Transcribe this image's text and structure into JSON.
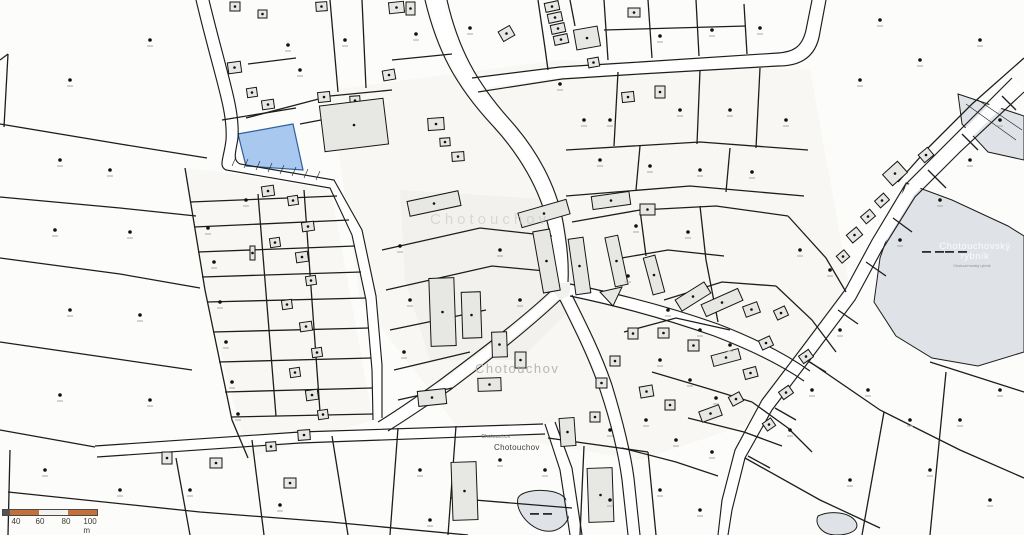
{
  "map": {
    "width": 1024,
    "height": 535,
    "colors": {
      "background": "#fcfcfa",
      "line": "#1d1d1b",
      "shade_village": "#f5f3ed",
      "shade_yard": "#efeeea",
      "building_fill": "#e7e7e4",
      "building_stroke": "#161616",
      "building_dot": "#111111",
      "highlight_fill": "#a9c8f0",
      "highlight_stroke": "#2f5f9e",
      "water_fill": "#dfe3e8",
      "road_fill": "#ffffff",
      "symbol": "#101010",
      "symbol_tick": "#a8a8a4",
      "scale_orange": "#c4703a",
      "scale_white": "#f5f2ee",
      "scale_end": "#555555"
    },
    "shaded_areas": [
      {
        "d": "M330,90 L560,60 L810,70 L850,290 L760,420 L640,460 L460,430 L360,300 Z",
        "fill": "#f5f3ed",
        "opacity": 0.55
      },
      {
        "d": "M185,168 L330,185 L373,420 L248,458 L205,290 Z",
        "fill": "#f4f2ec",
        "opacity": 0.5
      },
      {
        "d": "M400,190 L560,200 L580,300 L520,360 L430,360 L405,280 Z",
        "fill": "#efeeea",
        "opacity": 0.7
      }
    ],
    "water_areas": [
      {
        "d": "M906,183 L952,200 L1008,226 L1024,236 L1024,352 L978,366 L932,358 L896,336 L874,302 L880,258 Z"
      },
      {
        "d": "M958,94 L1024,116 L1024,160 L988,152 L962,124 Z"
      },
      {
        "d": "M518,498 C522,489 553,487 564,497 C574,508 570,524 556,530 C537,537 514,514 518,498 Z"
      },
      {
        "d": "M818,516 C830,510 850,512 856,522 C860,530 850,535 836,535 C822,535 814,524 818,516 Z"
      }
    ],
    "water_symbols": [
      [
        932,
        251
      ],
      [
        540,
        513
      ],
      [
        955,
        251
      ]
    ],
    "roads": [
      {
        "c": "M436,0 C447,49 465,84 501,122 C528,152 548,187 556,223 C560,246 562,265 562,283",
        "w": 14,
        "e": [
          "M425,0 C437,50 455,85 492,125 C520,155 540,190 548,225 C553,248 556,268 556,285",
          "M447,0 C458,48 476,82 510,120 C537,150 556,185 563,222 C567,245 569,263 568,282"
        ]
      },
      {
        "c": "M202,0 C221,79 234,109 232,139 C230,155 225,163 233,167 L332,184 L357,232 L371,298 L377,367 L377,419",
        "w": 12,
        "e": [
          "M196,0 C215,80 228,110 226,140 C224,158 218,166 226,170 L330,188 L352,235 L366,300 L372,370 L373,420",
          "M209,0 C228,78 240,108 238,138 C236,152 232,160 240,164 L334,180 L362,230 L376,296 L382,365 L382,418"
        ]
      },
      {
        "c": "M96,451 L300,437 L544,429",
        "w": 9,
        "e": [
          "M95,446 L300,432 L543,424",
          "M97,457 L300,443 L545,434"
        ]
      },
      {
        "c": "M556,295 C524,325 485,355 445,385 C420,402 401,415 383,426",
        "w": 9,
        "e": [
          "M552,290 C520,320 480,350 440,380 C415,398 396,411 378,422",
          "M560,300 C528,330 490,360 450,390 C425,407 406,420 388,431"
        ]
      },
      {
        "c": "M566,297 C581,327 596,357 606,387 C616,419 624,449 628,479 L634,535",
        "w": 10,
        "e": [
          "M560,300 C575,330 590,360 600,390 C610,420 618,450 622,480 L628,535",
          "M572,295 C587,325 602,355 612,385 C622,418 630,448 634,478 L640,535"
        ]
      },
      {
        "c": "M570,290 C619,300 668,313 716,330 C755,345 784,359 807,376",
        "w": 10,
        "e": [
          "M570,284 C620,294 670,307 718,324 C757,339 786,354 810,371",
          "M570,296 C618,306 666,319 714,336 C753,351 781,365 804,381"
        ]
      },
      {
        "c": "M1018,84 L955,146 L910,191 L877,245 L850,295 L805,355 L767,405 L740,454 L727,505 L723,535",
        "w": 11,
        "e": [
          "M1012,78 L950,140 L905,185 L872,240 L845,290 L800,350 L762,400 L735,450 L722,500 L718,535",
          "M1024,92 L960,152 L915,197 L882,250 L855,300 L810,360 L772,410 L745,458 L732,510 L728,535"
        ]
      },
      {
        "c": "M819,0 L813,31 C809,55 793,59 778,59 L640,68 L560,72 L474,84",
        "w": 11,
        "e": [
          "M812,0 L806,30 C802,48 792,52 778,53 L640,62 L560,67 L472,78",
          "M826,0 L820,32 C816,62 794,66 778,66 L640,74 L562,79 L478,92"
        ]
      },
      {
        "c": "M550,423 L566,469 L576,535",
        "w": 9,
        "e": [
          "M545,424 L560,470 L570,535",
          "M555,422 L572,468 L582,535"
        ]
      }
    ],
    "lines": [
      "M0,124 L120,144 L207,158",
      "M0,197 L120,208 L196,216",
      "M0,258 L120,274 L200,288",
      "M0,342 L110,358 L192,370",
      "M0,430 L95,447",
      "M10,450 L8,535",
      "M8,492 L200,512 L330,522 L468,535",
      "M176,458 L190,535",
      "M252,440 L264,535",
      "M332,436 L348,535",
      "M8,54 L4,127",
      "M0,60 L8,54",
      "M185,168 L205,290 L232,420 L248,458",
      "M190,202 L337,196",
      "M194,227 L349,220",
      "M198,252 L355,246",
      "M202,277 L361,272",
      "M207,302 L366,298",
      "M213,332 L369,328",
      "M219,362 L371,358",
      "M225,392 L372,388",
      "M231,417 L373,414",
      "M258,194 L276,416",
      "M304,190 L320,412",
      "M330,0 L338,92",
      "M362,0 L366,88",
      "M246,118 L330,96 L392,90",
      "M392,60 L452,54",
      "M248,64 L296,58",
      "M222,120 L296,108",
      "M300,124 L342,116",
      "M538,0 L545,48 L548,70",
      "M570,0 L575,26",
      "M604,0 L608,60",
      "M648,0 L652,58",
      "M696,0 L699,56",
      "M744,4 L747,54",
      "M604,30 L746,26",
      "M566,150 L700,142 L808,150",
      "M618,72 L614,146",
      "M700,70 L697,144",
      "M760,68 L756,148",
      "M566,196 L690,186 L804,196",
      "M640,146 L636,190",
      "M730,148 L726,192",
      "M572,222 L640,210 L716,206 L788,216",
      "M700,206 L706,260 L718,322",
      "M788,216 L826,258 L846,292",
      "M640,210 L646,256",
      "M610,260 L668,250 L724,256",
      "M664,300 L722,282 L776,286",
      "M624,332 L676,318 L730,330",
      "M652,372 L706,388 L752,402",
      "M688,418 L744,432 L782,446",
      "M776,286 L812,320 L836,352",
      "M752,402 L788,428 L812,452",
      "M622,448 L676,462 L718,476",
      "M930,362 L1024,392",
      "M810,362 L880,410 L960,450 L1024,478",
      "M745,458 L820,500 L880,528",
      "M946,372 L930,535",
      "M884,412 L862,535",
      "M398,428 L390,535",
      "M456,426 L448,535",
      "M450,498 L572,508",
      "M584,446 L580,535",
      "M648,452 L656,535",
      "M548,438 L648,452",
      "M1002,96 L1016,110",
      "M962,134 L978,150",
      "M928,170 L946,188",
      "M893,218 L912,232",
      "M866,262 L886,276",
      "M838,310 L858,324",
      "M806,360 L826,372",
      "M775,408 L796,420",
      "M748,456 L770,468",
      "M1024,58 L972,104 L930,146 L898,182",
      "M382,250 L480,228 L552,236",
      "M386,290 L492,266 L556,272",
      "M390,330 L486,310",
      "M394,370 L470,352",
      "M398,400 L452,388"
    ],
    "hatch_lines": [
      "M232,166 L236,157",
      "M244,168 L248,159",
      "M256,170 L260,161",
      "M268,172 L272,163",
      "M280,174 L284,165",
      "M292,176 L296,167",
      "M304,178 L308,169",
      "M316,180 L320,171",
      "M966,104 L1016,140",
      "M978,100 L1022,130"
    ],
    "highlight_parcel": {
      "d": "M238,134 L293,124 L303,170 L246,166 Z"
    },
    "buildings": [
      [
        230,
        2,
        10,
        9,
        0
      ],
      [
        258,
        10,
        9,
        8,
        0
      ],
      [
        316,
        2,
        11,
        9,
        -4
      ],
      [
        228,
        62,
        13,
        11,
        -8
      ],
      [
        247,
        88,
        10,
        9,
        -8
      ],
      [
        262,
        100,
        12,
        9,
        -8
      ],
      [
        318,
        92,
        12,
        10,
        -6
      ],
      [
        389,
        2,
        15,
        11,
        -6
      ],
      [
        406,
        2,
        9,
        13,
        0
      ],
      [
        383,
        70,
        12,
        10,
        -10
      ],
      [
        350,
        96,
        10,
        9,
        -4
      ],
      [
        428,
        118,
        16,
        12,
        -4
      ],
      [
        440,
        138,
        10,
        8,
        -4
      ],
      [
        452,
        152,
        12,
        9,
        -4
      ],
      [
        545,
        2,
        14,
        9,
        -12
      ],
      [
        548,
        13,
        14,
        9,
        -12
      ],
      [
        551,
        24,
        14,
        9,
        -12
      ],
      [
        554,
        35,
        14,
        9,
        -12
      ],
      [
        575,
        28,
        24,
        20,
        -10
      ],
      [
        588,
        58,
        11,
        9,
        -10
      ],
      [
        622,
        92,
        12,
        10,
        -6
      ],
      [
        655,
        86,
        10,
        12,
        0
      ],
      [
        628,
        8,
        12,
        9,
        0
      ],
      [
        500,
        28,
        13,
        11,
        -30
      ],
      [
        322,
        102,
        64,
        46,
        -7
      ],
      [
        408,
        196,
        52,
        15,
        -12
      ],
      [
        519,
        206,
        50,
        15,
        -16
      ],
      [
        538,
        230,
        17,
        62,
        -10
      ],
      [
        572,
        238,
        15,
        56,
        -8
      ],
      [
        430,
        278,
        25,
        68,
        -2
      ],
      [
        462,
        292,
        19,
        46,
        -2
      ],
      [
        492,
        332,
        15,
        25,
        -2
      ],
      [
        515,
        352,
        11,
        16,
        0
      ],
      [
        478,
        378,
        23,
        13,
        -2
      ],
      [
        418,
        390,
        28,
        15,
        -6
      ],
      [
        592,
        194,
        38,
        13,
        -8
      ],
      [
        640,
        204,
        15,
        11,
        0
      ],
      [
        610,
        236,
        13,
        50,
        -12
      ],
      [
        648,
        256,
        12,
        38,
        -15
      ],
      [
        676,
        290,
        34,
        13,
        -32
      ],
      [
        702,
        296,
        40,
        13,
        -24
      ],
      [
        744,
        304,
        15,
        11,
        -20
      ],
      [
        658,
        328,
        11,
        10,
        0
      ],
      [
        628,
        328,
        10,
        11,
        0
      ],
      [
        688,
        340,
        11,
        11,
        0
      ],
      [
        712,
        352,
        28,
        11,
        -15
      ],
      [
        744,
        368,
        13,
        10,
        -15
      ],
      [
        610,
        356,
        10,
        10,
        0
      ],
      [
        596,
        378,
        11,
        10,
        0
      ],
      [
        640,
        386,
        13,
        11,
        -10
      ],
      [
        665,
        400,
        10,
        10,
        0
      ],
      [
        700,
        408,
        21,
        11,
        -20
      ],
      [
        590,
        412,
        10,
        10,
        0
      ],
      [
        730,
        394,
        12,
        10,
        -28
      ],
      [
        760,
        338,
        12,
        10,
        -25
      ],
      [
        775,
        308,
        12,
        10,
        -25
      ],
      [
        560,
        418,
        15,
        28,
        -4
      ],
      [
        588,
        468,
        25,
        54,
        -2
      ],
      [
        452,
        462,
        25,
        58,
        -2
      ],
      [
        298,
        430,
        12,
        10,
        -4
      ],
      [
        266,
        442,
        10,
        9,
        -4
      ],
      [
        162,
        452,
        10,
        12,
        0
      ],
      [
        210,
        458,
        12,
        10,
        0
      ],
      [
        284,
        478,
        12,
        10,
        0
      ],
      [
        262,
        186,
        12,
        10,
        -8
      ],
      [
        288,
        196,
        10,
        9,
        -8
      ],
      [
        302,
        222,
        12,
        9,
        -8
      ],
      [
        270,
        238,
        10,
        9,
        -8
      ],
      [
        296,
        252,
        12,
        10,
        -8
      ],
      [
        306,
        276,
        10,
        9,
        -8
      ],
      [
        282,
        300,
        10,
        9,
        -8
      ],
      [
        300,
        322,
        12,
        9,
        -8
      ],
      [
        312,
        348,
        10,
        9,
        -8
      ],
      [
        290,
        368,
        10,
        9,
        -8
      ],
      [
        306,
        390,
        12,
        10,
        -8
      ],
      [
        318,
        410,
        10,
        9,
        -8
      ],
      [
        250,
        246,
        5,
        14,
        0
      ],
      [
        876,
        196,
        12,
        9,
        -42
      ],
      [
        862,
        212,
        12,
        9,
        -40
      ],
      [
        848,
        230,
        13,
        10,
        -40
      ],
      [
        838,
        252,
        10,
        9,
        -40
      ],
      [
        885,
        166,
        20,
        15,
        -42
      ],
      [
        920,
        150,
        12,
        10,
        -40
      ],
      [
        800,
        352,
        12,
        9,
        -35
      ],
      [
        780,
        388,
        12,
        9,
        -35
      ],
      [
        764,
        420,
        10,
        9,
        -35
      ]
    ],
    "extra_shapes": [
      {
        "d": "M600,292 L622,287 L613,306 Z",
        "fill": "#e7e7e4",
        "stroke": "#161616"
      }
    ],
    "symbols": [
      [
        70,
        80
      ],
      [
        150,
        40
      ],
      [
        60,
        160
      ],
      [
        110,
        170
      ],
      [
        55,
        230
      ],
      [
        130,
        232
      ],
      [
        70,
        310
      ],
      [
        140,
        315
      ],
      [
        60,
        395
      ],
      [
        150,
        400
      ],
      [
        45,
        470
      ],
      [
        120,
        490
      ],
      [
        288,
        45
      ],
      [
        345,
        40
      ],
      [
        300,
        70
      ],
      [
        208,
        228
      ],
      [
        214,
        262
      ],
      [
        220,
        302
      ],
      [
        226,
        342
      ],
      [
        232,
        382
      ],
      [
        238,
        414
      ],
      [
        246,
        200
      ],
      [
        416,
        34
      ],
      [
        470,
        28
      ],
      [
        560,
        84
      ],
      [
        584,
        120
      ],
      [
        610,
        120
      ],
      [
        660,
        36
      ],
      [
        712,
        30
      ],
      [
        760,
        28
      ],
      [
        680,
        110
      ],
      [
        730,
        110
      ],
      [
        786,
        120
      ],
      [
        860,
        80
      ],
      [
        920,
        60
      ],
      [
        980,
        40
      ],
      [
        880,
        20
      ],
      [
        400,
        246
      ],
      [
        410,
        300
      ],
      [
        404,
        352
      ],
      [
        500,
        250
      ],
      [
        520,
        300
      ],
      [
        600,
        160
      ],
      [
        650,
        166
      ],
      [
        700,
        170
      ],
      [
        752,
        172
      ],
      [
        636,
        226
      ],
      [
        688,
        232
      ],
      [
        628,
        276
      ],
      [
        668,
        310
      ],
      [
        700,
        330
      ],
      [
        730,
        345
      ],
      [
        660,
        360
      ],
      [
        690,
        380
      ],
      [
        716,
        398
      ],
      [
        646,
        420
      ],
      [
        610,
        430
      ],
      [
        676,
        440
      ],
      [
        712,
        452
      ],
      [
        800,
        250
      ],
      [
        830,
        270
      ],
      [
        868,
        390
      ],
      [
        910,
        420
      ],
      [
        960,
        420
      ],
      [
        1000,
        390
      ],
      [
        930,
        470
      ],
      [
        850,
        480
      ],
      [
        990,
        500
      ],
      [
        420,
        470
      ],
      [
        500,
        460
      ],
      [
        430,
        520
      ],
      [
        545,
        470
      ],
      [
        610,
        500
      ],
      [
        660,
        490
      ],
      [
        700,
        510
      ],
      [
        190,
        490
      ],
      [
        280,
        505
      ],
      [
        790,
        430
      ],
      [
        812,
        390
      ],
      [
        840,
        330
      ],
      [
        900,
        240
      ],
      [
        940,
        200
      ],
      [
        970,
        160
      ],
      [
        1000,
        120
      ]
    ],
    "labels": {
      "watermark_upper": {
        "text": "Chotouchov",
        "x": 430,
        "y": 212,
        "size": 15,
        "color": "#c2bfb8",
        "opacity": 0.5,
        "spacing": 4,
        "align": "left"
      },
      "watermark_center": {
        "text": "Chotouchov",
        "x": 475,
        "y": 362,
        "size": 13,
        "color": "#b3b1ab",
        "opacity": 0.9,
        "spacing": 1.5,
        "align": "left"
      },
      "village_small": {
        "text": "Chotouchov",
        "x": 481,
        "y": 434,
        "size": 5.5,
        "color": "#77776f",
        "opacity": 1,
        "spacing": 0,
        "align": "left"
      },
      "village": {
        "text": "Chotouchov",
        "x": 494,
        "y": 444,
        "size": 8,
        "color": "#3d3d3b",
        "opacity": 1,
        "spacing": 0.3,
        "align": "left"
      },
      "pond_watermark": {
        "text": "Chotouchovský rybník",
        "x": 975,
        "y": 242,
        "size": 9.5,
        "color": "#ffffff",
        "opacity": 0.85,
        "spacing": 0.5,
        "align": "center",
        "width": 84
      },
      "pond_small": {
        "text": "Chotouchovský rybník",
        "x": 972,
        "y": 264,
        "size": 3.8,
        "color": "#8a8f94",
        "opacity": 1,
        "spacing": 0,
        "align": "center",
        "width": 120
      }
    },
    "scalebar": {
      "x": 2,
      "y": 509,
      "height": 7,
      "segments": [
        {
          "width": 7,
          "color": "#555555"
        },
        {
          "width": 29,
          "color": "#c4703a"
        },
        {
          "width": 29,
          "color": "#f5f2ee"
        },
        {
          "width": 29,
          "color": "#c4703a"
        }
      ],
      "labels": [
        {
          "text": "40",
          "x": 14
        },
        {
          "text": "60",
          "x": 38
        },
        {
          "text": "80",
          "x": 64
        },
        {
          "text": "100 m",
          "x": 88
        }
      ]
    }
  }
}
